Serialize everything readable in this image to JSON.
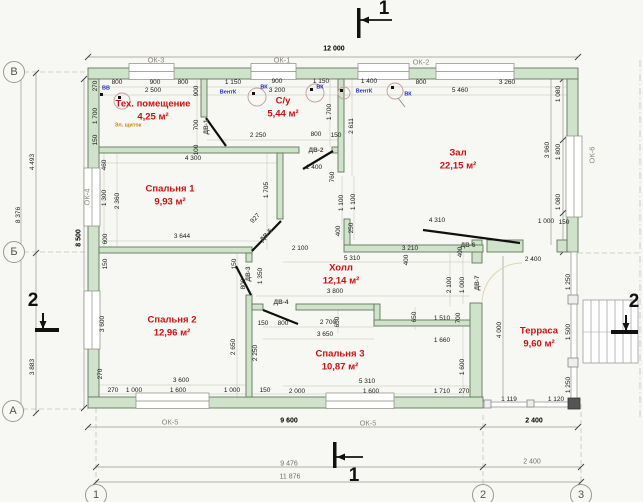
{
  "colors": {
    "wall_fill": "#cfe2ca",
    "wall_stroke": "#60795c",
    "thin_line": "#b9b9b2",
    "room_text": "#cc1111",
    "marker_blue": "#2030c0",
    "marker_orange": "#cc8500"
  },
  "rooms": [
    {
      "id": "tech-room",
      "name": "Тех. помещение",
      "area": "4,25 м²",
      "x": 153,
      "y": 104
    },
    {
      "id": "bathroom",
      "name": "С/у",
      "area": "5,44 м²",
      "x": 283,
      "y": 101
    },
    {
      "id": "hall-main",
      "name": "Зал",
      "area": "22,15 м²",
      "x": 458,
      "y": 153
    },
    {
      "id": "bedroom-1",
      "name": "Спальня 1",
      "area": "9,93 м²",
      "x": 170,
      "y": 189
    },
    {
      "id": "hallway",
      "name": "Холл",
      "area": "12,14 м²",
      "x": 341,
      "y": 268
    },
    {
      "id": "bedroom-2",
      "name": "Спальня 2",
      "area": "12,96 м²",
      "x": 172,
      "y": 320
    },
    {
      "id": "bedroom-3",
      "name": "Спальня 3",
      "area": "10,87 м²",
      "x": 340,
      "y": 354
    },
    {
      "id": "terrace",
      "name": "Терраса",
      "area": "9,60 м²",
      "x": 539,
      "y": 331
    }
  ],
  "labels": [
    {
      "t": "12 000",
      "x": 334,
      "y": 49,
      "c": "dimb"
    },
    {
      "t": "800",
      "x": 117,
      "y": 83
    },
    {
      "t": "900",
      "x": 155,
      "y": 83
    },
    {
      "t": "800",
      "x": 183,
      "y": 83
    },
    {
      "t": "2 500",
      "x": 153,
      "y": 91
    },
    {
      "t": "1 150",
      "x": 233,
      "y": 83
    },
    {
      "t": "900",
      "x": 277,
      "y": 82
    },
    {
      "t": "1 150",
      "x": 321,
      "y": 82
    },
    {
      "t": "3 200",
      "x": 277,
      "y": 91
    },
    {
      "t": "1 400",
      "x": 369,
      "y": 82
    },
    {
      "t": "800",
      "x": 421,
      "y": 83
    },
    {
      "t": "3 260",
      "x": 507,
      "y": 83
    },
    {
      "t": "5 460",
      "x": 460,
      "y": 91
    },
    {
      "t": "270",
      "x": 96,
      "y": 86,
      "r": -90
    },
    {
      "t": "1 700",
      "x": 96,
      "y": 116,
      "r": -90
    },
    {
      "t": "150",
      "x": 96,
      "y": 140,
      "r": -90
    },
    {
      "t": "460",
      "x": 105,
      "y": 165,
      "r": -90
    },
    {
      "t": "1 300",
      "x": 105,
      "y": 198,
      "r": -90
    },
    {
      "t": "2 360",
      "x": 118,
      "y": 201,
      "r": -90
    },
    {
      "t": "600",
      "x": 106,
      "y": 239,
      "r": -90
    },
    {
      "t": "150",
      "x": 106,
      "y": 264,
      "r": -90
    },
    {
      "t": "3 600",
      "x": 103,
      "y": 324,
      "r": -90
    },
    {
      "t": "270",
      "x": 101,
      "y": 374,
      "r": -90
    },
    {
      "t": "4 493",
      "x": 33,
      "y": 162,
      "r": -90
    },
    {
      "t": "8 376",
      "x": 19,
      "y": 215,
      "r": -90
    },
    {
      "t": "8 500",
      "x": 79,
      "y": 238,
      "r": -90,
      "c": "dimb"
    },
    {
      "t": "3 883",
      "x": 33,
      "y": 367,
      "r": -90
    },
    {
      "t": "4 300",
      "x": 193,
      "y": 159
    },
    {
      "t": "900",
      "x": 197,
      "y": 91,
      "r": -90
    },
    {
      "t": "700",
      "x": 197,
      "y": 125,
      "r": -90
    },
    {
      "t": "100",
      "x": 197,
      "y": 150,
      "r": -90
    },
    {
      "t": "2 250",
      "x": 258,
      "y": 136
    },
    {
      "t": "800",
      "x": 316,
      "y": 135
    },
    {
      "t": "150",
      "x": 336,
      "y": 136
    },
    {
      "t": "1 700",
      "x": 330,
      "y": 112,
      "r": -90
    },
    {
      "t": "2 611",
      "x": 352,
      "y": 126,
      "r": -90
    },
    {
      "t": "1 400",
      "x": 314,
      "y": 168
    },
    {
      "t": "760",
      "x": 333,
      "y": 177,
      "r": -90
    },
    {
      "t": "1 705",
      "x": 267,
      "y": 190,
      "r": -90
    },
    {
      "t": "927",
      "x": 256,
      "y": 219,
      "r": -48
    },
    {
      "t": "3 644",
      "x": 182,
      "y": 237
    },
    {
      "t": "1 100",
      "x": 342,
      "y": 203,
      "r": -90
    },
    {
      "t": "1 100",
      "x": 354,
      "y": 202,
      "r": -90
    },
    {
      "t": "400",
      "x": 339,
      "y": 231,
      "r": -90
    },
    {
      "t": "250",
      "x": 352,
      "y": 228,
      "r": -90
    },
    {
      "t": "2 100",
      "x": 300,
      "y": 249
    },
    {
      "t": "3 210",
      "x": 410,
      "y": 249
    },
    {
      "t": "5 310",
      "x": 352,
      "y": 259
    },
    {
      "t": "3 800",
      "x": 335,
      "y": 292
    },
    {
      "t": "4 310",
      "x": 437,
      "y": 221
    },
    {
      "t": "400",
      "x": 407,
      "y": 260,
      "r": -90
    },
    {
      "t": "400",
      "x": 461,
      "y": 252,
      "r": -90
    },
    {
      "t": "2 100",
      "x": 450,
      "y": 285,
      "r": -90
    },
    {
      "t": "1 000",
      "x": 463,
      "y": 285,
      "r": -90
    },
    {
      "t": "1 000",
      "x": 546,
      "y": 222
    },
    {
      "t": "150",
      "x": 564,
      "y": 223
    },
    {
      "t": "3 960",
      "x": 548,
      "y": 150,
      "r": -90
    },
    {
      "t": "1 080",
      "x": 559,
      "y": 94,
      "r": -90
    },
    {
      "t": "1 800",
      "x": 559,
      "y": 152,
      "r": -90
    },
    {
      "t": "1 080",
      "x": 559,
      "y": 202,
      "r": -90
    },
    {
      "t": "150",
      "x": 235,
      "y": 264,
      "r": -90
    },
    {
      "t": "800",
      "x": 244,
      "y": 284,
      "r": -90
    },
    {
      "t": "1 350",
      "x": 261,
      "y": 276,
      "r": -90
    },
    {
      "t": "2 650",
      "x": 234,
      "y": 347,
      "r": -90
    },
    {
      "t": "2 250",
      "x": 256,
      "y": 353,
      "r": -90
    },
    {
      "t": "150",
      "x": 263,
      "y": 324
    },
    {
      "t": "800",
      "x": 283,
      "y": 324
    },
    {
      "t": "2 700",
      "x": 328,
      "y": 323
    },
    {
      "t": "3 650",
      "x": 325,
      "y": 335
    },
    {
      "t": "650",
      "x": 338,
      "y": 322,
      "r": -90
    },
    {
      "t": "650",
      "x": 415,
      "y": 317,
      "r": -90
    },
    {
      "t": "1 510",
      "x": 442,
      "y": 319
    },
    {
      "t": "700",
      "x": 459,
      "y": 318,
      "r": -90
    },
    {
      "t": "1 660",
      "x": 442,
      "y": 341
    },
    {
      "t": "1 600",
      "x": 463,
      "y": 367,
      "r": -90
    },
    {
      "t": "5 310",
      "x": 367,
      "y": 382
    },
    {
      "t": "2 000",
      "x": 297,
      "y": 392
    },
    {
      "t": "1 600",
      "x": 371,
      "y": 392
    },
    {
      "t": "1 710",
      "x": 442,
      "y": 392
    },
    {
      "t": "270",
      "x": 464,
      "y": 392
    },
    {
      "t": "3 600",
      "x": 181,
      "y": 381
    },
    {
      "t": "270",
      "x": 113,
      "y": 391
    },
    {
      "t": "1 000",
      "x": 134,
      "y": 391
    },
    {
      "t": "1 600",
      "x": 178,
      "y": 391
    },
    {
      "t": "1 000",
      "x": 232,
      "y": 391
    },
    {
      "t": "150",
      "x": 265,
      "y": 391
    },
    {
      "t": "2 400",
      "x": 533,
      "y": 260
    },
    {
      "t": "4 000",
      "x": 500,
      "y": 330,
      "r": -90
    },
    {
      "t": "1 250",
      "x": 569,
      "y": 282,
      "r": -90
    },
    {
      "t": "1 500",
      "x": 569,
      "y": 332,
      "r": -90
    },
    {
      "t": "1 250",
      "x": 569,
      "y": 385,
      "r": -90
    },
    {
      "t": "1 119",
      "x": 509,
      "y": 400
    },
    {
      "t": "1 120",
      "x": 556,
      "y": 400
    },
    {
      "t": "2 400",
      "x": 534,
      "y": 421,
      "c": "dimb"
    },
    {
      "t": "9 600",
      "x": 289,
      "y": 421,
      "c": "dimb"
    },
    {
      "t": "9 476",
      "x": 289,
      "y": 464,
      "c": "dimg"
    },
    {
      "t": "11 876",
      "x": 290,
      "y": 477,
      "c": "dimg"
    },
    {
      "t": "2 400",
      "x": 532,
      "y": 462,
      "c": "dimg"
    },
    {
      "t": "ОК-3",
      "x": 156,
      "y": 60,
      "c": "ok"
    },
    {
      "t": "ОК-1",
      "x": 282,
      "y": 60,
      "c": "ok"
    },
    {
      "t": "ОК-2",
      "x": 421,
      "y": 62,
      "c": "ok"
    },
    {
      "t": "ОК-4",
      "x": 87,
      "y": 197,
      "r": -90,
      "c": "ok"
    },
    {
      "t": "ОК-6",
      "x": 592,
      "y": 155,
      "r": -90,
      "c": "ok"
    },
    {
      "t": "ОК-5",
      "x": 170,
      "y": 422,
      "c": "ok"
    },
    {
      "t": "ОК-5",
      "x": 368,
      "y": 423,
      "c": "ok"
    },
    {
      "t": "ДВ-1",
      "x": 207,
      "y": 127,
      "r": -90,
      "c": "dv"
    },
    {
      "t": "ДВ-2",
      "x": 316,
      "y": 151,
      "c": "dv"
    },
    {
      "t": "ДВ-3",
      "x": 249,
      "y": 274,
      "r": -90,
      "c": "dv"
    },
    {
      "t": "ДВ-4",
      "x": 281,
      "y": 303,
      "c": "dv"
    },
    {
      "t": "ДВ-5",
      "x": 267,
      "y": 236,
      "r": -48,
      "c": "dv"
    },
    {
      "t": "ДВ-6",
      "x": 468,
      "y": 246,
      "c": "dv"
    },
    {
      "t": "ДВ-7",
      "x": 478,
      "y": 283,
      "r": -90,
      "c": "dv"
    },
    {
      "t": "ВВ",
      "x": 106,
      "y": 89,
      "c": "blue"
    },
    {
      "t": "ВентК",
      "x": 228,
      "y": 93,
      "c": "blue"
    },
    {
      "t": "ВК",
      "x": 264,
      "y": 88,
      "c": "blue"
    },
    {
      "t": "ВК",
      "x": 320,
      "y": 88,
      "c": "blue"
    },
    {
      "t": "ВентК",
      "x": 364,
      "y": 92,
      "c": "blue"
    },
    {
      "t": "ВК",
      "x": 408,
      "y": 95,
      "c": "blue"
    },
    {
      "t": "Эл. щиток",
      "x": 128,
      "y": 126,
      "c": "orange"
    }
  ],
  "axes": [
    {
      "t": "В",
      "x": 14,
      "y": 72
    },
    {
      "t": "Б",
      "x": 14,
      "y": 252
    },
    {
      "t": "А",
      "x": 13,
      "y": 411
    },
    {
      "t": "1",
      "x": 96,
      "y": 495
    },
    {
      "t": "2",
      "x": 483,
      "y": 495
    },
    {
      "t": "3",
      "x": 581,
      "y": 495
    }
  ],
  "sections": [
    {
      "t": "1",
      "x": 384,
      "y": 9
    },
    {
      "t": "1",
      "x": 354,
      "y": 476
    },
    {
      "t": "2",
      "x": 33,
      "y": 301
    },
    {
      "t": "2",
      "x": 634,
      "y": 302
    }
  ]
}
